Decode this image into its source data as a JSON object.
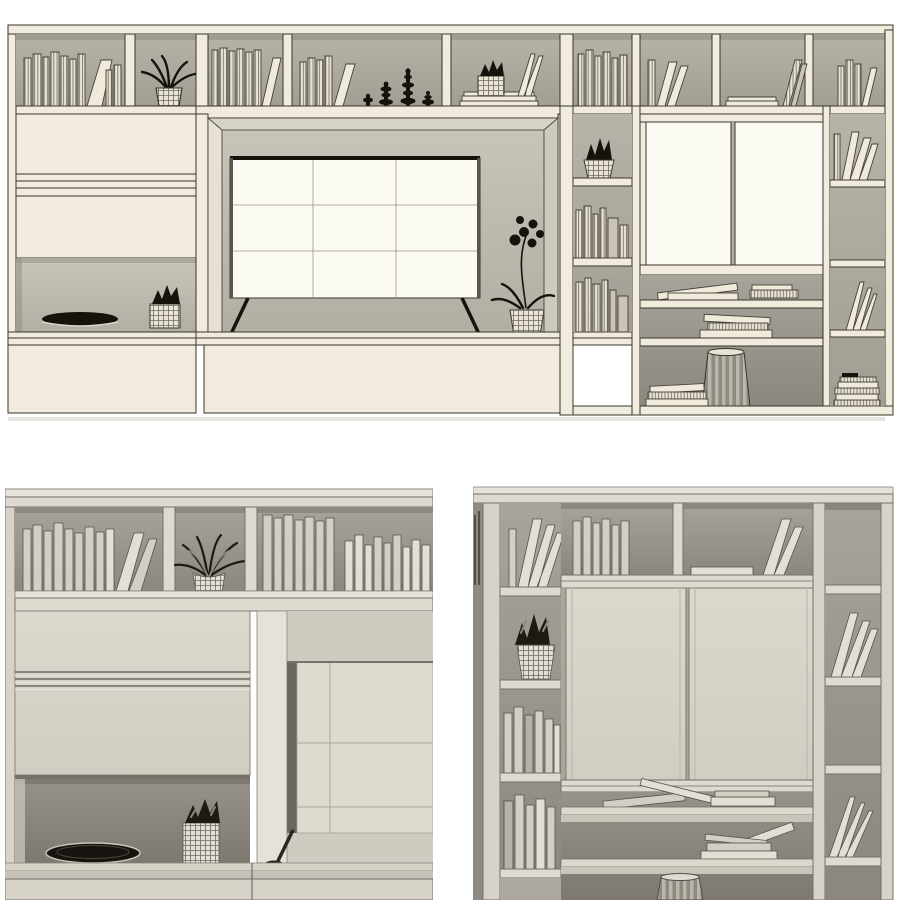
{
  "page": {
    "background": "#ffffff",
    "kind": "3d-furniture-model-preview"
  },
  "palette": {
    "page-bg": "#ffffff",
    "a-cream": "#f0ebdc",
    "a-white": "#fcfbf3",
    "a-line": "#38342c",
    "a-dark": "#16130d",
    "a-back": "#aba79c",
    "b-board": "#dedad0",
    "b-panel": "#d7d3c8",
    "b-book": "#d3cfc4",
    "b-line": "#74706a",
    "b-dark": "#1d1a14",
    "b-back": "#9b978e"
  },
  "views": [
    {
      "id": "top-elevation",
      "style": "sketch-wireframe",
      "objects": [
        "wall-unit",
        "top-shelf-books",
        "hanging-plant-pot",
        "black-candlestick-decor",
        "cube-succulent-planter",
        "tv",
        "tv-stand-legs",
        "orchid-plant",
        "closed-drawers",
        "open-niche-with-tray",
        "succulent-cube",
        "narrow-shelf-column",
        "succulent-basket",
        "sliding-door-cabinet",
        "stacked-flat-books",
        "fluted-side-table",
        "leaning-books",
        "book-stack"
      ]
    },
    {
      "id": "detail-left-cabinet",
      "style": "clay-render",
      "objects": [
        "top-shelf-books",
        "spider-plant-pot",
        "tall-books",
        "closed-cabinet-door",
        "groove-handle-band",
        "open-niche",
        "woven-tray",
        "succulent-cube-pot",
        "tv-corner",
        "tv-stand-leg",
        "base-counter"
      ]
    },
    {
      "id": "detail-right-bookcase",
      "style": "clay-render",
      "objects": [
        "leaning-books",
        "succulent-wire-basket",
        "book-columns",
        "sliding-doors",
        "top-shelf-books",
        "flat-book",
        "open-shelves",
        "stacked-flat-books",
        "fluted-side-table",
        "book-fan"
      ]
    }
  ]
}
